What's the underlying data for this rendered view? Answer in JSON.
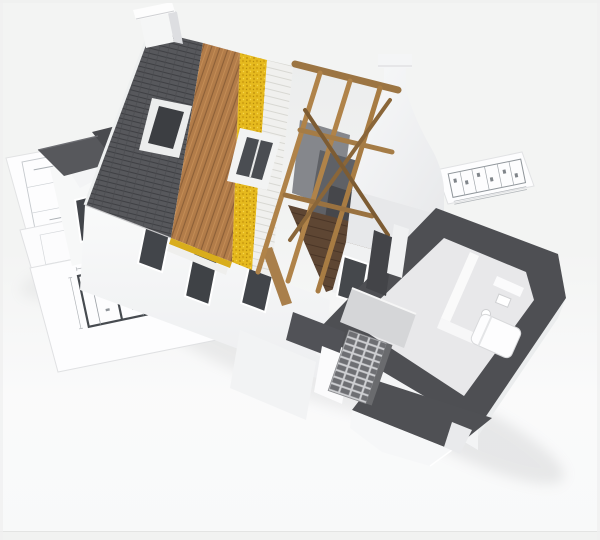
{
  "scene": {
    "description": "3D architectural rendering of a house under construction, cut away to show roof layers (shingles, wood sheathing, yellow insulation, battens, exposed timber trusses) and a dollhouse-style ground floor interior, standing on spread-out blueprint floor plans.",
    "parts": [
      {
        "name": "shingle-roof",
        "label": "Dark shingle roof slope with skylight"
      },
      {
        "name": "wood-sheathing",
        "label": "Exposed wooden roof sheathing"
      },
      {
        "name": "insulation-layer",
        "label": "Yellow insulation strip"
      },
      {
        "name": "batten-layer",
        "label": "White batten / membrane strip"
      },
      {
        "name": "timber-trusses",
        "label": "Bare timber rafters and braces"
      },
      {
        "name": "dutch-gable",
        "label": "White curved gable with chimney cap"
      },
      {
        "name": "chimney",
        "label": "White chimney at ridge"
      },
      {
        "name": "cutaway-floor",
        "label": "Cutaway ground floor with dark wall tops, kitchen and bathroom"
      },
      {
        "name": "brick-wall-section",
        "label": "Exposed brick wall section"
      },
      {
        "name": "blueprints",
        "label": "Blueprint sheets with floor plans"
      }
    ]
  },
  "palette": {
    "background": "#f3f4f3",
    "ground": "#fbfbfc",
    "shingle": "#57585c",
    "shingle_dark": "#46474b",
    "extension_roof": "#4a4b4f",
    "sheathing_wood": "#b27c49",
    "insulation": "#e6ba1e",
    "insulation_edge": "#d9ad1c",
    "lath_white": "#f0f0ee",
    "white_wall": "#f7f8f8",
    "wall_bright": "#fbfbfc",
    "wall_shade": "#e7e8ea",
    "wall_shade_dark": "#dddee1",
    "wall_top_dark": "#4e4f53",
    "roof_flat_dark": "#515257",
    "timber": "#b08349",
    "timber_dark": "#8a6639",
    "attic_panel": "#5f6166",
    "attic_panel_light": "#85878c",
    "glass_dark": "#42454a",
    "floor_interior": "#e8e8ea",
    "counter_gray": "#d5d6d8",
    "flue_dark": "#434448",
    "blueprint_sheet": "#fdfdfe",
    "blueprint_line": "#9ba0a5",
    "blueprint_wall": "#474b50",
    "frame_strip": "#f1f2f1",
    "frame_line": "#e3e4e3"
  }
}
